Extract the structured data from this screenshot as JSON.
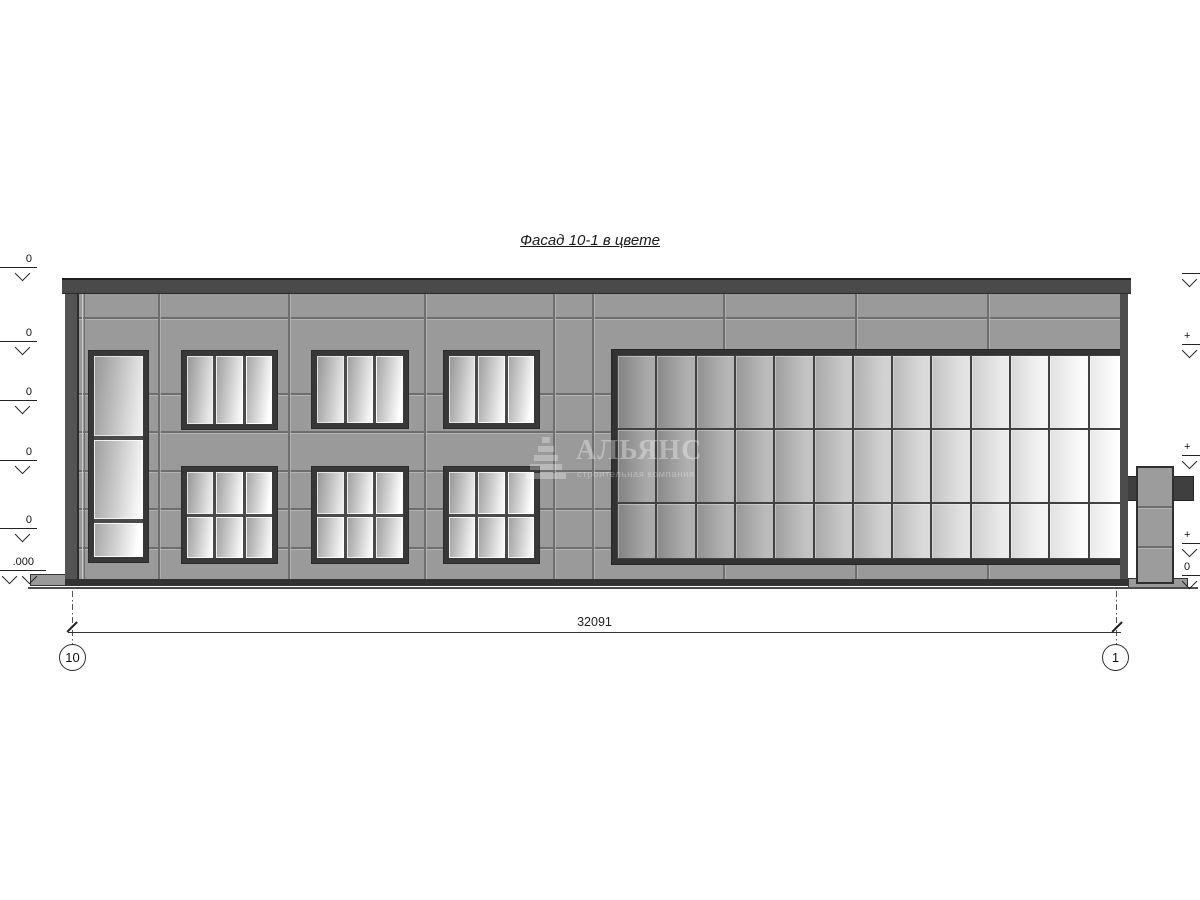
{
  "drawing": {
    "title": "Фасад 10-1 в цвете",
    "dimension_label": "32091",
    "axis_left": "10",
    "axis_right": "1",
    "elevation_marks_left": [
      "0",
      "0",
      "0",
      "0",
      "0"
    ],
    "elevation_mark_left_bottom": ".000",
    "elevation_marks_right": [
      "",
      "+",
      "+",
      "+",
      "0"
    ],
    "watermark": {
      "name": "АЛЬЯНС",
      "tagline": "строительная компания"
    },
    "facade": {
      "curtain_wall": {
        "columns": 13,
        "rows": 3
      },
      "windows_upper_count": 3,
      "windows_lower_count": 3,
      "windows_tall_count": 1
    },
    "colors": {
      "facade": "#9a9a9a",
      "frame": "#383838",
      "parapet": "#4a4a4a",
      "glass_light": "#ffffff"
    }
  }
}
